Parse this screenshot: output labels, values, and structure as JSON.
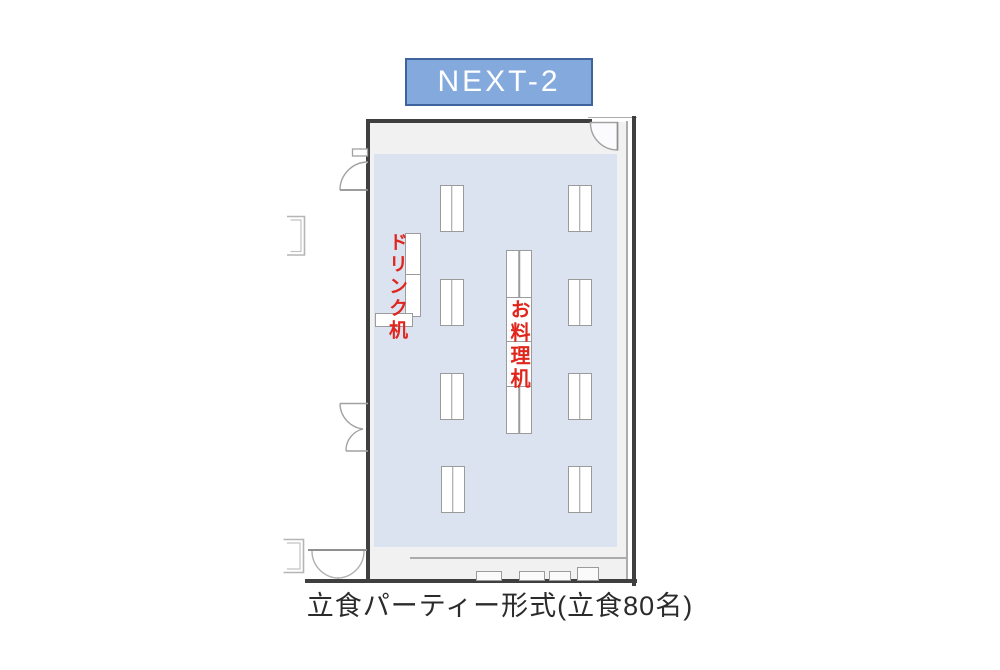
{
  "title": {
    "label": "NEXT-2"
  },
  "caption": {
    "text": "立食パーティー形式(立食80名)"
  },
  "labels": {
    "drink_table": "ドリンク机",
    "food_table": "お料理机"
  },
  "colors": {
    "title_fill": "#84aadd",
    "title_border": "#3f639c",
    "floor_carpet": "#dbe3f1",
    "room_background": "#f1f1f2",
    "wall": "#3f3f3f",
    "table_border": "#9b9b9b",
    "table_fill": "#ffffff",
    "label_red": "#e0261c"
  },
  "floorplan": {
    "room": {
      "x": 368,
      "y": 120,
      "width": 269,
      "height": 462
    },
    "carpet": {
      "x": 374,
      "y": 154,
      "width": 243,
      "height": 393
    },
    "guest_table_size": {
      "w": 23.5,
      "h": 46.5
    },
    "guest_tables": [
      {
        "x": 440,
        "y": 185
      },
      {
        "x": 568,
        "y": 185
      },
      {
        "x": 440,
        "y": 279
      },
      {
        "x": 568,
        "y": 279
      },
      {
        "x": 440,
        "y": 373
      },
      {
        "x": 568,
        "y": 373
      },
      {
        "x": 441,
        "y": 466
      },
      {
        "x": 568,
        "y": 466
      }
    ],
    "food_table_segments": [
      {
        "x": 506,
        "y": 250,
        "w": 26,
        "h": 48,
        "div": true
      },
      {
        "x": 506,
        "y": 297,
        "w": 26,
        "h": 45,
        "div": false
      },
      {
        "x": 506,
        "y": 341,
        "w": 26,
        "h": 46,
        "div": false
      },
      {
        "x": 506,
        "y": 386,
        "w": 26,
        "h": 48,
        "div": true
      }
    ],
    "drink_table_segments": [
      {
        "x": 405,
        "y": 233,
        "w": 16,
        "h": 42
      },
      {
        "x": 405,
        "y": 274,
        "w": 16,
        "h": 43
      },
      {
        "x": 375,
        "y": 313,
        "w": 38,
        "h": 14
      }
    ],
    "wall_notches": [
      {
        "x": 476,
        "y": 571,
        "w": 26,
        "h": 10
      },
      {
        "x": 519,
        "y": 571,
        "w": 26,
        "h": 10
      },
      {
        "x": 549,
        "y": 571,
        "w": 22,
        "h": 10
      },
      {
        "x": 577,
        "y": 567,
        "w": 22,
        "h": 14
      }
    ]
  }
}
